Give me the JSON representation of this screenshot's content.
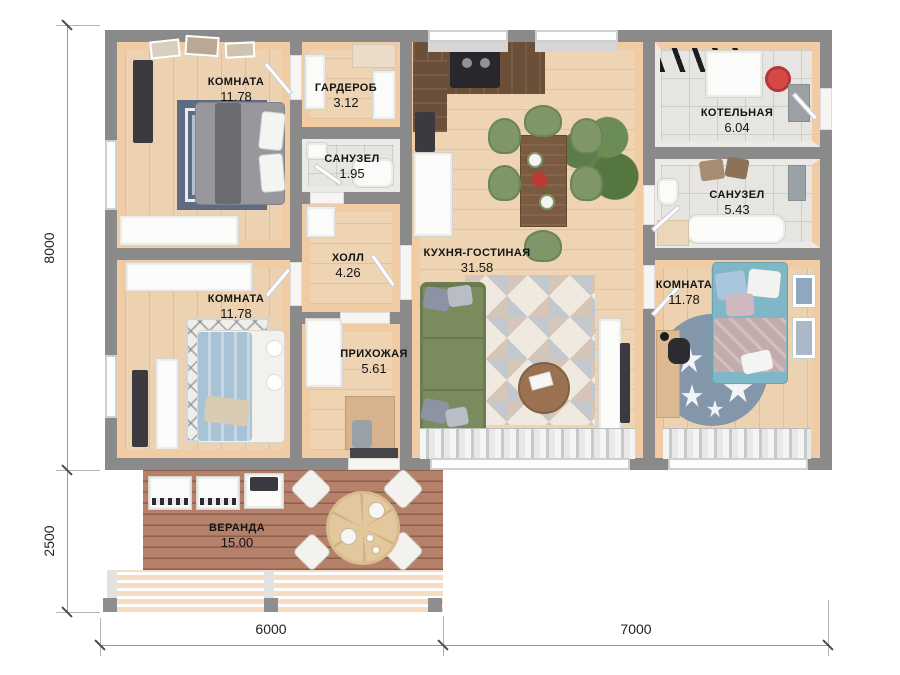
{
  "rooms": [
    {
      "id": "bedroom-top-left",
      "name": "КОМНАТА",
      "area": "11.78"
    },
    {
      "id": "wardrobe",
      "name": "ГАРДЕРОБ",
      "area": "3.12"
    },
    {
      "id": "bathroom-small",
      "name": "САНУЗЕЛ",
      "area": "1.95"
    },
    {
      "id": "hall",
      "name": "ХОЛЛ",
      "area": "4.26"
    },
    {
      "id": "entry-hall",
      "name": "ПРИХОЖАЯ",
      "area": "5.61"
    },
    {
      "id": "bedroom-mid-left",
      "name": "КОМНАТА",
      "area": "11.78"
    },
    {
      "id": "kitchen-living",
      "name": "КУХНЯ-ГОСТИНАЯ",
      "area": "31.58"
    },
    {
      "id": "boiler-room",
      "name": "КОТЕЛЬНАЯ",
      "area": "6.04"
    },
    {
      "id": "bathroom-big",
      "name": "САНУЗЕЛ",
      "area": "5.43"
    },
    {
      "id": "bedroom-right",
      "name": "КОМНАТА",
      "area": "11.78"
    },
    {
      "id": "veranda",
      "name": "ВЕРАНДА",
      "area": "15.00"
    }
  ],
  "dimensions": {
    "house_height": "8000",
    "veranda_height": "2500",
    "width_left": "6000",
    "width_right": "7000"
  },
  "colors": {
    "wall": "#8a8a8a",
    "wood_floor": "#ecd2b1",
    "wood_trim": "#f1cba3",
    "tile_floor": "#e6e5e2",
    "veranda_deck": "#b5816b",
    "sofa_green": "#7a8c5e",
    "bed_teal": "#7fb7c6",
    "bed_blue": "#a9c3d6",
    "boiler_red": "#d84848",
    "rug_blue_grey": "#8396aa"
  }
}
